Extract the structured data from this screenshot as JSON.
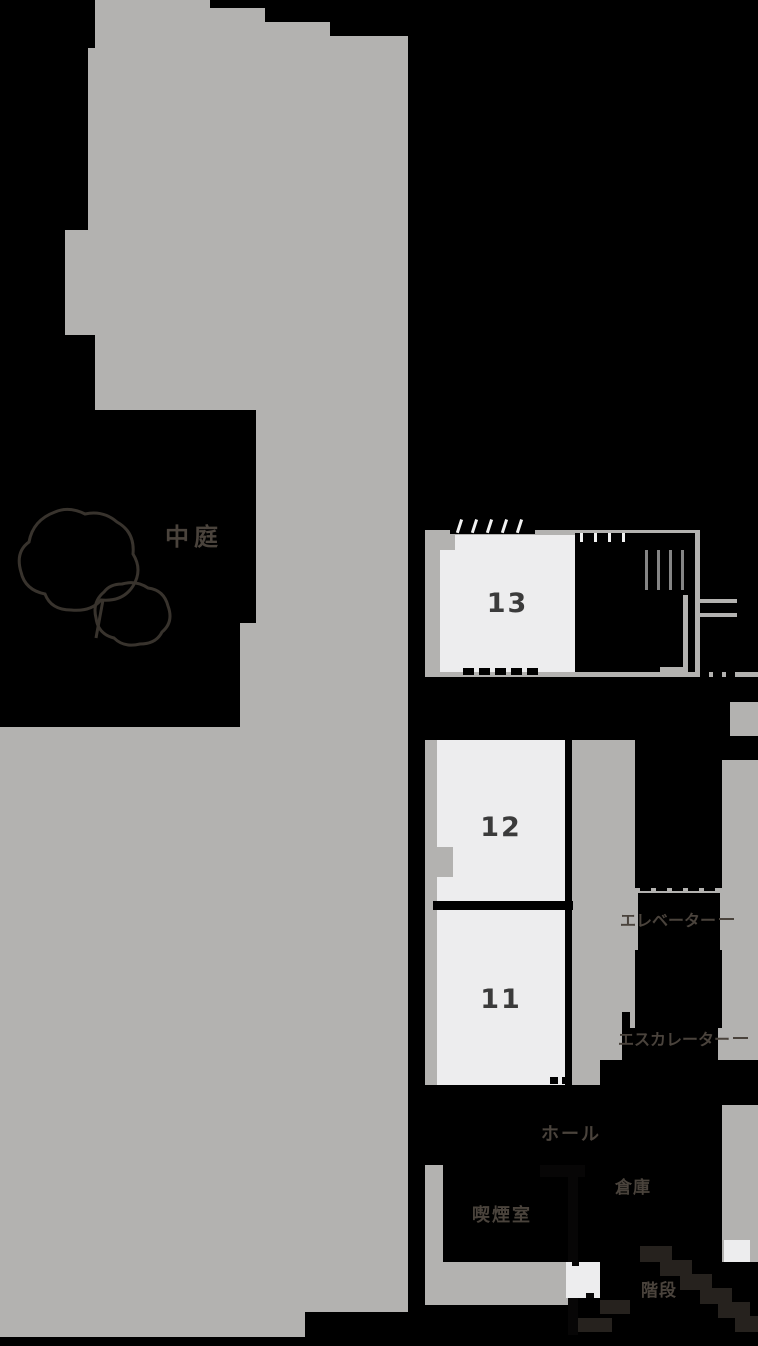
{
  "floorplan": {
    "title": "facility-floor-map",
    "rooms": [
      {
        "id": "room-13",
        "label": "13"
      },
      {
        "id": "room-12",
        "label": "12"
      },
      {
        "id": "room-11",
        "label": "11"
      }
    ],
    "labels": {
      "courtyard": "中庭",
      "elevator": "エレベーター",
      "escalator": "エスカレーター",
      "hall": "ホール",
      "smoking_room": "喫煙室",
      "storage": "倉庫",
      "stairs": "階段"
    },
    "colors": {
      "background": "#000000",
      "building": "#b3b2b0",
      "room_fill": "#ededee",
      "room_number_text": "#3b3b3b",
      "label_text": "#4a433c",
      "wall": "#070606",
      "tick_white": "#f2f2f2",
      "step_dark": "#26221e",
      "tree_outline": "#38332d"
    }
  }
}
